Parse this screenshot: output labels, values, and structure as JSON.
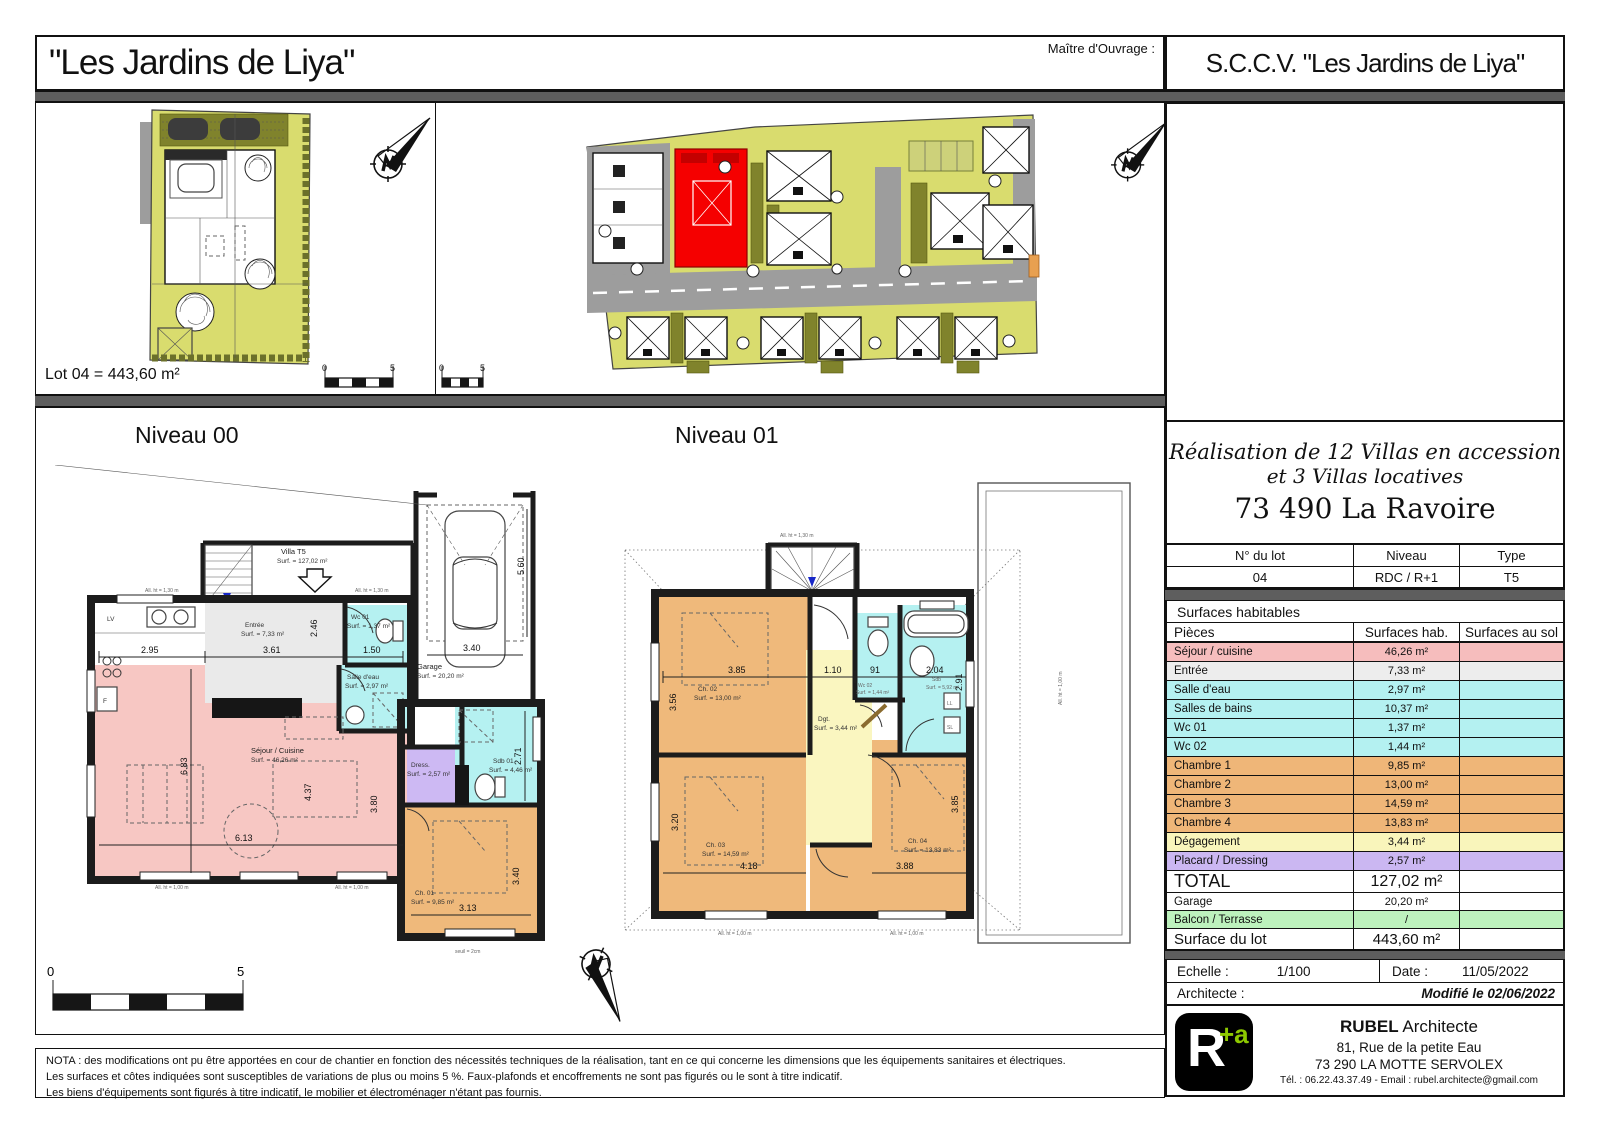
{
  "header": {
    "project_title": "\"Les Jardins de Liya\"",
    "owner_label": "Maître d'Ouvrage :",
    "owner_name": "S.C.C.V. \"Les Jardins de Liya\""
  },
  "top": {
    "lot_area_label": "Lot 04 = 443,60 m²",
    "scale_zero": "0",
    "scale_five": "5"
  },
  "plans": {
    "level0_title": "Niveau 00",
    "level1_title": "Niveau 01",
    "villa_label": "Villa T5",
    "villa_surf": "Surf. = 127,02 m²",
    "seuil_note": "seuil = 2cm",
    "alt130": "All. ht = 1,30 m",
    "alt100": "All. ht = 1,00 m",
    "kitchen_lv": "LV",
    "kitchen_f": "F",
    "appliance_ll": "LL",
    "appliance_sl": "SL",
    "p0_rooms": {
      "wc01": {
        "n": "Wc 01",
        "s": "Surf. = 1,37 m²"
      },
      "se": {
        "n": "Salle d'eau",
        "s": "Surf. = 2,97 m²"
      },
      "entree": {
        "n": "Entrée",
        "s": "Surf. = 7,33 m²"
      },
      "sejour": {
        "n": "Séjour / Cuisine",
        "s": "Surf. = 46,26 m²"
      },
      "garage": {
        "n": "Garage",
        "s": "Surf. = 20,20 m²"
      },
      "dress": {
        "n": "Dress.",
        "s": "Surf. = 2,57 m²"
      },
      "sdb01": {
        "n": "Sdb 01",
        "s": "Surf. = 4,46 m²"
      },
      "ch01": {
        "n": "Ch. 01",
        "s": "Surf. = 9,85 m²"
      }
    },
    "p0_dims": {
      "a": "2.95",
      "b": "3.61",
      "c": "2.46",
      "d": "1.50",
      "e": "6.83",
      "f": "4.37",
      "g": "3.80",
      "h": "6.13",
      "i": "3.13",
      "j": "3.40",
      "k": "2.71",
      "l": "3.40",
      "m": "5.60"
    },
    "p1_rooms": {
      "ch02": {
        "n": "Ch. 02",
        "s": "Surf. = 13,00 m²"
      },
      "dgt": {
        "n": "Dgt.",
        "s": "Surf. = 3,44 m²"
      },
      "wc02": {
        "n": "Wc 02",
        "s": "Surf. = 1,44 m²"
      },
      "sdb": {
        "n": "Sdb",
        "s": "Surf. = 5,92 m²"
      },
      "ch03": {
        "n": "Ch. 03",
        "s": "Surf. = 14,59 m²"
      },
      "ch04": {
        "n": "Ch. 04",
        "s": "Surf. = 13,83 m²"
      }
    },
    "p1_dims": {
      "a": "3.85",
      "b": "3.56",
      "c": "1.10",
      "d": "91",
      "e": "2.04",
      "f": "2.91",
      "g": "3.20",
      "h": "4.18",
      "i": "3.88",
      "j": "3.85"
    }
  },
  "panel": {
    "realisation_l1": "Réalisation de 12 Villas en accession",
    "realisation_l2": "et 3 Villas locatives",
    "realisation_l3": "73 490 La Ravoire",
    "lot_header": [
      "N° du lot",
      "Niveau",
      "Type"
    ],
    "lot_values": [
      "04",
      "RDC / R+1",
      "T5"
    ],
    "surfaces_title": "Surfaces habitables",
    "cols": [
      "Pièces",
      "Surfaces hab.",
      "Surfaces au sol"
    ],
    "rows": [
      {
        "label": "Séjour / cuisine",
        "value": "46,26 m²",
        "style": "background:#F6BDBD"
      },
      {
        "label": "Entrée",
        "value": "7,33 m²",
        "style": "background:#EDEDED"
      },
      {
        "label": "Salle d'eau",
        "value": "2,97 m²",
        "style": "background:#B4F1F1"
      },
      {
        "label": "Salles de bains",
        "value": "10,37 m²",
        "style": "background:#B4F1F1"
      },
      {
        "label": "Wc 01",
        "value": "1,37 m²",
        "style": "background:#B4F1F1"
      },
      {
        "label": "Wc 02",
        "value": "1,44 m²",
        "style": "background:#B4F1F1"
      },
      {
        "label": "Chambre 1",
        "value": "9,85 m²",
        "style": "background:#EFB678"
      },
      {
        "label": "Chambre 2",
        "value": "13,00 m²",
        "style": "background:#EFB678"
      },
      {
        "label": "Chambre 3",
        "value": "14,59 m²",
        "style": "background:#EFB678"
      },
      {
        "label": "Chambre 4",
        "value": "13,83 m²",
        "style": "background:#EFB678"
      },
      {
        "label": "Dégagement",
        "value": "3,44 m²",
        "style": "background:#F9F5BB"
      },
      {
        "label": "Placard / Dressing",
        "value": "2,57 m²",
        "style": "background:#CBB7F2"
      }
    ],
    "total_label": "TOTAL",
    "total_value": "127,02 m²",
    "garage_label": "Garage",
    "garage_value": "20,20 m²",
    "balcon_label": "Balcon / Terrasse",
    "balcon_value": "/",
    "balcon_style": "background:#BDF2BD",
    "surflot_label": "Surface du lot",
    "surflot_value": "443,60 m²",
    "echelle_label": "Echelle :",
    "echelle_value": "1/100",
    "date_label": "Date :",
    "date_value": "11/05/2022",
    "architecte_label": "Architecte :",
    "modified": "Modifié le 02/06/2022",
    "firm": {
      "logo_main": "R",
      "logo_sup": "+a",
      "name_bold": "RUBEL",
      "name_rest": " Architecte",
      "addr1": "81, Rue de la petite Eau",
      "addr2": "73 290 LA MOTTE SERVOLEX",
      "contact": "Tél. : 06.22.43.37.49 - Email : rubel.architecte@gmail.com"
    },
    "accent_green": "#8DC800"
  },
  "nota": {
    "l1": "NOTA : des modifications ont pu être apportées en cour de chantier en fonction des nécessités techniques de la réalisation, tant en ce qui concerne les dimensions que les équipements sanitaires et électriques.",
    "l2": "Les surfaces et côtes indiquées sont susceptibles de variations de plus ou moins 5 %. Faux-plafonds et encoffrements ne sont pas figurés ou le sont à titre indicatif.",
    "l3": "Les biens d'équipements sont figurés à titre indicatif, le mobilier et électroménager n'étant pas fournis."
  },
  "colors": {
    "sejour_pink": "#F6BDBD",
    "entree_gray": "#EDEDED",
    "wet_cyan": "#B4F1F1",
    "chambre_orange": "#EFB678",
    "degagement_yellow": "#F9F5BB",
    "placard_purple": "#CBB7F2",
    "balcon_green": "#BDF2BD",
    "lot_green": "#D9DC6E",
    "road_gray": "#9D9D9D",
    "highlight_red": "#F50000",
    "band_gray": "#5E5E5E"
  }
}
